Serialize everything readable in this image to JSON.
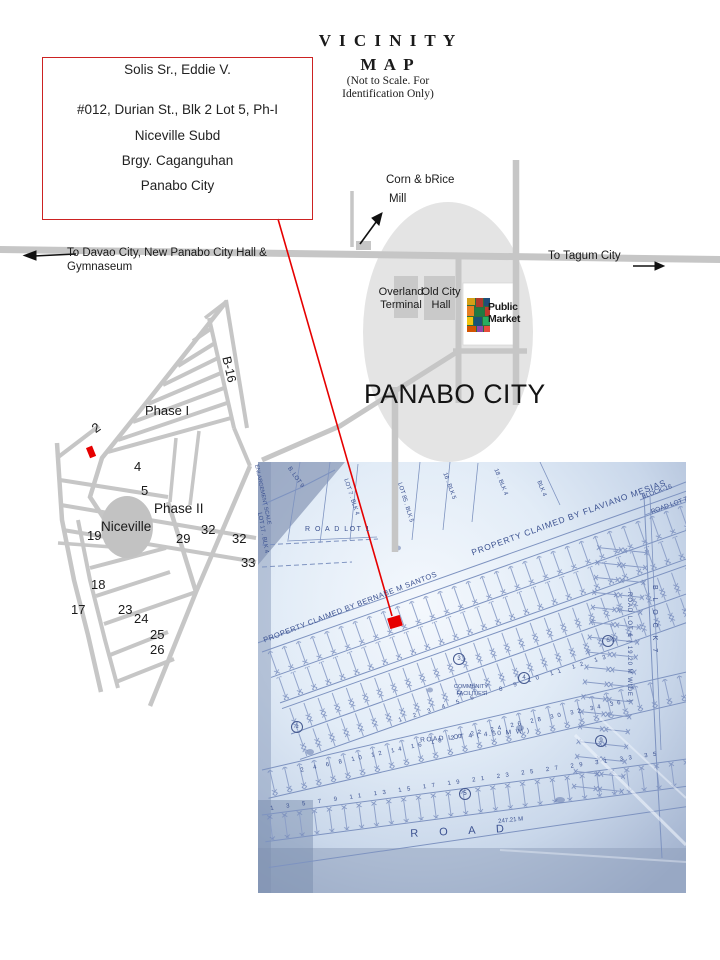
{
  "colors": {
    "accent_red": "#e60000",
    "road_gray": "#c6c6c6",
    "city_ellipse_gray": "#e4e4e4",
    "building_gray": "#c9c9c9",
    "niceville_gray": "#c2c2c2",
    "photo_line_blue": "#7e93c0"
  },
  "title": {
    "line1": "V I C I N I T Y",
    "line2": "M A P",
    "note_line1": "(Not to Scale. For",
    "note_line2": "Identification Only)"
  },
  "address_box": {
    "name": "Solis Sr., Eddie V.",
    "street": "#012, Durian St., Blk  2 Lot  5,  Ph-I",
    "subdivision": "Niceville Subd",
    "barangay": "Brgy. Caganguhan",
    "city": "Panabo City"
  },
  "highway": {
    "west_label_line1": "To Davao City, New Panabo City Hall &",
    "west_label_line2": "Gymnaseum",
    "east_label": "To Tagum City"
  },
  "landmarks": {
    "mill_line1": "Corn & bRice",
    "mill_line2": "Mill",
    "terminal_line1": "Overland",
    "terminal_line2": "Terminal",
    "city_hall_line1": "Old City",
    "city_hall_line2": "Hall",
    "market_line1": "Public",
    "market_line2": "Market",
    "city_name": "PANABO CITY"
  },
  "subdivision_map": {
    "road_b16": "B-16",
    "phase1": "Phase I",
    "phase2": "Phase II",
    "niceville": "Niceville",
    "block_numbers": [
      "2",
      "4",
      "5",
      "19",
      "29",
      "32",
      "32",
      "33",
      "18",
      "17",
      "23",
      "24",
      "25",
      "26"
    ]
  },
  "photo": {
    "property_mesias": "PROPERTY CLAIMED BY FLAVIANO MESIAS",
    "property_santos": "PROPERTY CLAIMED BY BERNABE M SANTOS",
    "road_lot_1": "R O A D   LOT   1",
    "road_lot_4": "ROAD  LOT  4  ( 4.50 M W )",
    "road_lot_6": "ROAD LOT 6 ( 19.20 M WIDE )",
    "road_lot_7": "ROAD LOT 7",
    "block_16": "BLOCK-16",
    "block_7": "B L O C K   7",
    "road_label": "R  O  A  D",
    "community": "COMMUNITY FACILITIES",
    "measurement": "247.21 M",
    "margin_notes": [
      "LOT 7 . BLK 4",
      "LOT 85 . BLK 5",
      "16 . BLK 5",
      "18 . BLK 4",
      "BLK 4",
      "LOT 17 . BLK 4",
      "B. LOT 9",
      "ENLARGEMENT SCALE"
    ],
    "lot_rows": {
      "top": "1  2  3  4  5  6  7  8  9  10  11  12  13",
      "middle": "2  4  6  8  10  12  14  16  18  20  22  24  26  28  30  32  34  36",
      "bottom": "1  3  5  7  9  11  13  15  17  19  21  23  25  27  29  31  33  35"
    },
    "circled_lots": [
      "1",
      "3",
      "4",
      "5",
      "6",
      "9"
    ]
  }
}
